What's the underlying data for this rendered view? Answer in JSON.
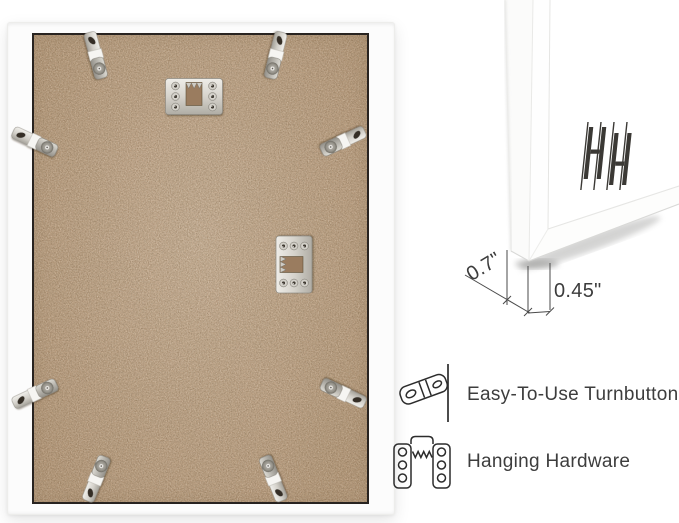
{
  "back_view": {
    "frame_color": "#fcfcfc",
    "backing_color": "#c2a486",
    "turnbutton_count": 8,
    "sawtooth_hanger_count": 2
  },
  "corner_view": {
    "dimension_labels": [
      "0.7\"",
      "0.45\""
    ],
    "logo_text": "HH"
  },
  "callouts": [
    {
      "icon": "turnbutton-icon",
      "label": "Easy-To-Use Turnbuttons"
    },
    {
      "icon": "sawtooth-hanger-icon",
      "label": "Hanging Hardware"
    }
  ],
  "colors": {
    "background": "#ffffff",
    "line_art": "#2c2c2c",
    "dimension_text": "#3c3c3c",
    "backing_outline": "#282320"
  }
}
